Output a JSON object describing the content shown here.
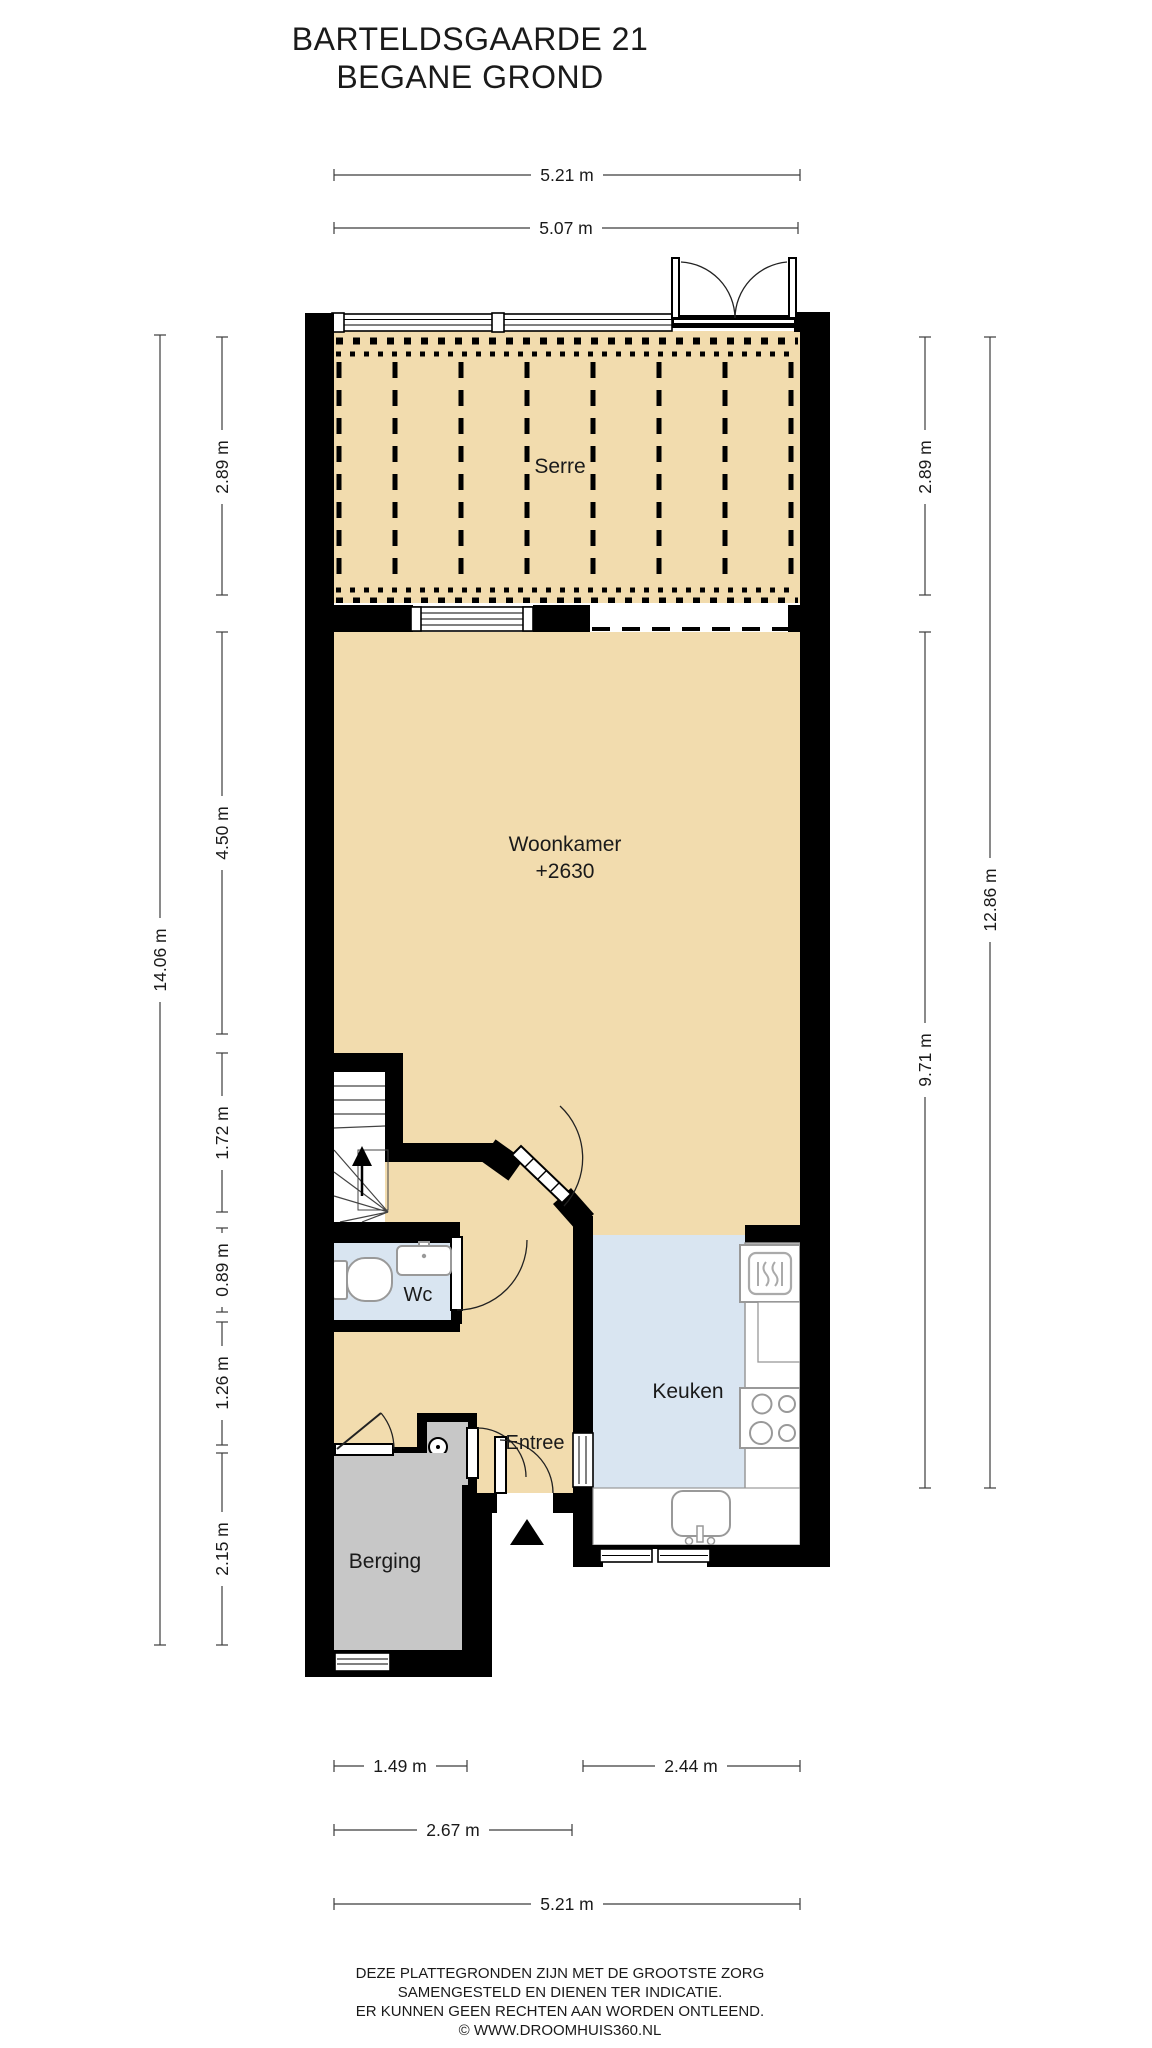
{
  "title": {
    "line1": "BARTELDSGAARDE 21",
    "line2": "BEGANE GROND"
  },
  "rooms": [
    {
      "id": "serre",
      "label": "Serre"
    },
    {
      "id": "woonkamer",
      "label": "Woonkamer",
      "sublabel": "+2630"
    },
    {
      "id": "keuken",
      "label": "Keuken"
    },
    {
      "id": "wc",
      "label": "Wc"
    },
    {
      "id": "entree",
      "label": "Entree"
    },
    {
      "id": "berging",
      "label": "Berging"
    }
  ],
  "dimensions": {
    "top": [
      {
        "label": "5.21 m"
      },
      {
        "label": "5.07 m"
      }
    ],
    "left": [
      {
        "label": "14.06 m"
      },
      {
        "label": "2.89 m"
      },
      {
        "label": "4.50 m"
      },
      {
        "label": "1.72 m"
      },
      {
        "label": "0.89 m"
      },
      {
        "label": "1.26 m"
      },
      {
        "label": "2.15 m"
      }
    ],
    "right": [
      {
        "label": "2.89 m"
      },
      {
        "label": "9.71 m"
      },
      {
        "label": "12.86 m"
      }
    ],
    "bottom": [
      {
        "label": "1.49 m"
      },
      {
        "label": "2.44 m"
      },
      {
        "label": "2.67 m"
      },
      {
        "label": "5.21 m"
      }
    ]
  },
  "footer": {
    "line1": "DEZE PLATTEGRONDEN ZIJN MET DE GROOTSTE ZORG",
    "line2": "SAMENGESTELD EN DIENEN TER INDICATIE.",
    "line3": "ER KUNNEN GEEN RECHTEN AAN WORDEN ONTLEEND.",
    "line4": "© WWW.DROOMHUIS360.NL"
  },
  "colors": {
    "floor_wood": "#F2DCAE",
    "floor_tile": "#D9E5F1",
    "floor_storage": "#C7C7C7",
    "wall": "#000000"
  }
}
